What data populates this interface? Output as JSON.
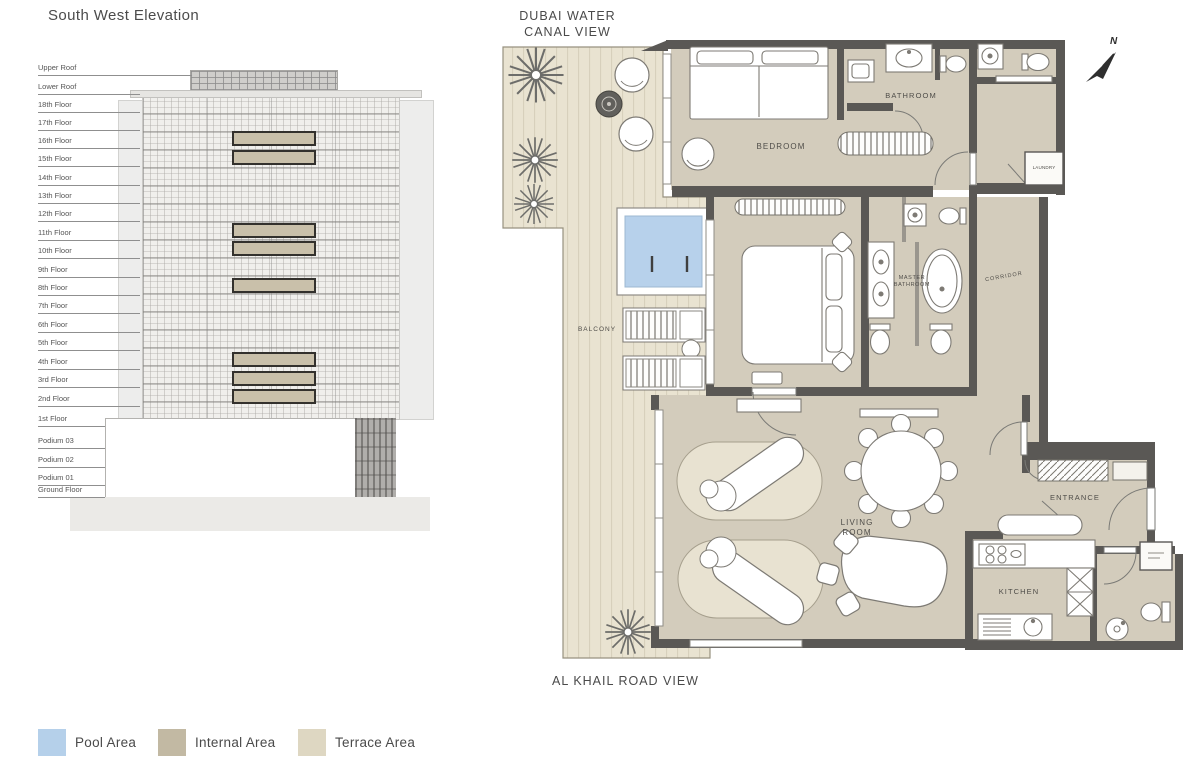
{
  "elevation": {
    "title": "South West Elevation",
    "floors": [
      {
        "label": "Upper Roof",
        "highlighted": false
      },
      {
        "label": "Lower Roof",
        "highlighted": false
      },
      {
        "label": "18th Floor",
        "highlighted": false
      },
      {
        "label": "17th Floor",
        "highlighted": false
      },
      {
        "label": "16th Floor",
        "highlighted": true
      },
      {
        "label": "15th Floor",
        "highlighted": true
      },
      {
        "label": "14th Floor",
        "highlighted": false
      },
      {
        "label": "13th Floor",
        "highlighted": false
      },
      {
        "label": "12th Floor",
        "highlighted": false
      },
      {
        "label": "11th Floor",
        "highlighted": true
      },
      {
        "label": "10th Floor",
        "highlighted": true
      },
      {
        "label": "9th Floor",
        "highlighted": false
      },
      {
        "label": "8th Floor",
        "highlighted": true
      },
      {
        "label": "7th Floor",
        "highlighted": false
      },
      {
        "label": "6th Floor",
        "highlighted": false
      },
      {
        "label": "5th Floor",
        "highlighted": false
      },
      {
        "label": "4th Floor",
        "highlighted": true
      },
      {
        "label": "3rd Floor",
        "highlighted": true
      },
      {
        "label": "2nd Floor",
        "highlighted": true
      },
      {
        "label": "1st Floor",
        "highlighted": false
      },
      {
        "label": "Podium 03",
        "highlighted": false
      },
      {
        "label": "Podium 02",
        "highlighted": false
      },
      {
        "label": "Podium 01",
        "highlighted": false
      },
      {
        "label": "Ground Floor",
        "highlighted": false
      }
    ]
  },
  "plan": {
    "caption_top_line1": "DUBAI WATER",
    "caption_top_line2": "CANAL VIEW",
    "caption_bottom": "AL KHAIL ROAD VIEW",
    "compass": "N",
    "rooms": {
      "bedroom": "BEDROOM",
      "bathroom": "BATHROOM",
      "laundry": "LAUNDRY",
      "master_bathroom_line1": "MASTER",
      "master_bathroom_line2": "BATHROOM",
      "corridor": "CORRIDOR",
      "balcony": "BALCONY",
      "living_line1": "LIVING",
      "living_line2": "ROOM",
      "entrance": "ENTRANCE",
      "kitchen": "KITCHEN"
    }
  },
  "legend": {
    "items": [
      {
        "label": "Pool Area",
        "color": "#b5d0ea"
      },
      {
        "label": "Internal Area",
        "color": "#c2b9a3"
      },
      {
        "label": "Terrace Area",
        "color": "#ded7c2"
      }
    ]
  },
  "colors": {
    "wall": "#5a5855",
    "internal_fill": "#d3ccbc",
    "terrace_fill": "#e9e3d1",
    "pool_fill": "#b7d1eb"
  }
}
